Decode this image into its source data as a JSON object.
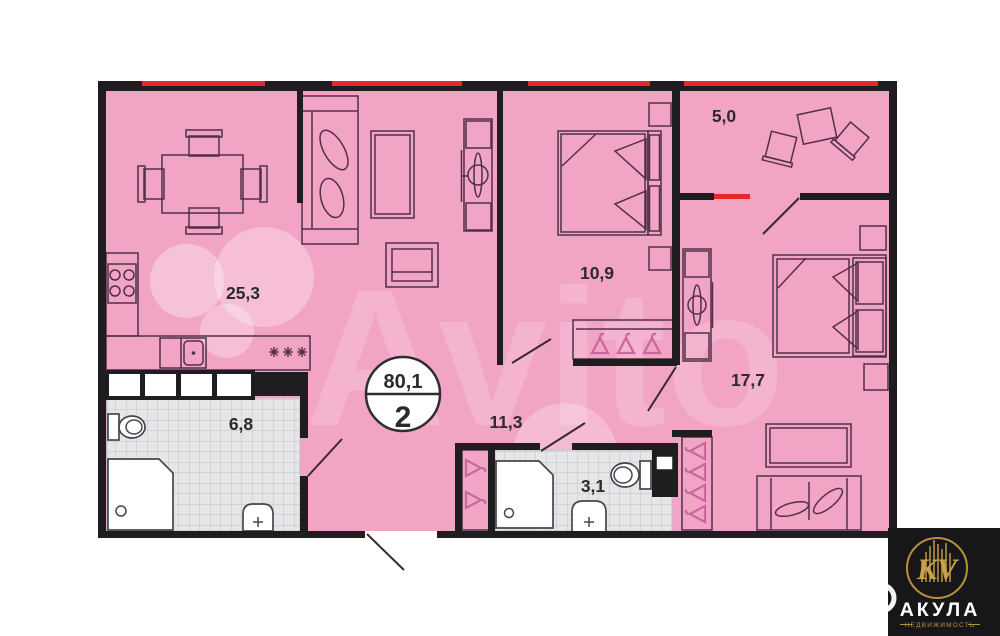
{
  "plan": {
    "badge": {
      "total_area": "80,1",
      "rooms_count": "2"
    },
    "rooms": [
      {
        "name": "kitchen-living-room",
        "area": "25,3"
      },
      {
        "name": "bedroom-1",
        "area": "10,9"
      },
      {
        "name": "balcony",
        "area": "5,0"
      },
      {
        "name": "bedroom-2",
        "area": "17,7"
      },
      {
        "name": "bathroom",
        "area": "6,8"
      },
      {
        "name": "hallway",
        "area": "11,3"
      },
      {
        "name": "wc",
        "area": "3,1"
      }
    ]
  },
  "watermark": {
    "text": "Avito"
  },
  "logo": {
    "monogram": "KV",
    "name": "АКУЛА",
    "tagline": "НЕДВИЖИМОСТЬ"
  },
  "colors": {
    "floor_pink": "#f2a4c5",
    "wall_black": "#201d20",
    "window_red": "#e8262b",
    "tile_gray": "#e6e6e8",
    "furniture_stroke": "#533046",
    "hanger_pink": "#c9679f",
    "logo_gold": "#b8913d",
    "logo_bg": "#17171a"
  }
}
